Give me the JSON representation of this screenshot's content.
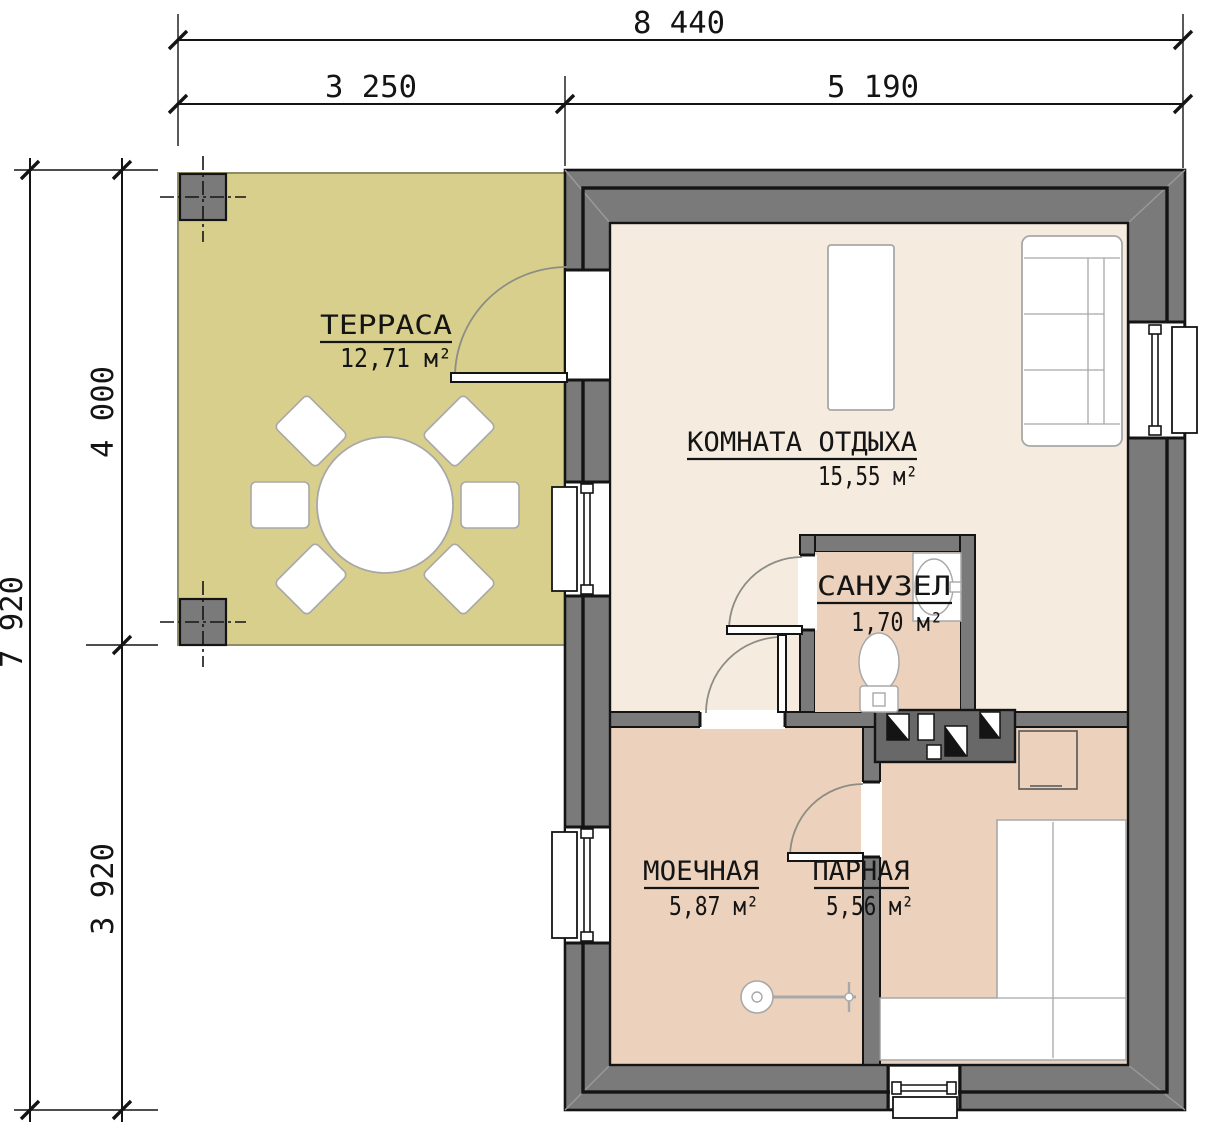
{
  "dimensions": {
    "top": {
      "total": "8 440",
      "seg1": "3 250",
      "seg2": "5 190"
    },
    "left": {
      "total": "7 920",
      "seg1": "4 000",
      "seg2": "3 920"
    }
  },
  "rooms": {
    "terrace": {
      "name": "ТЕРРАСА",
      "area": "12,71 м²"
    },
    "lounge": {
      "name": "КОМНАТА ОТДЫХА",
      "area": "15,55 м²"
    },
    "bathroom": {
      "name": "САНУЗЕЛ",
      "area": "1,70 м²"
    },
    "washroom": {
      "name": "МОЕЧНАЯ",
      "area": "5,87 м²"
    },
    "steamroom": {
      "name": "ПАРНАЯ",
      "area": "5,56 м²"
    }
  },
  "colors": {
    "wall": "#7a7a7a",
    "wall_dark": "#686868",
    "outline": "#141414",
    "terrace_floor": "#d8cf8d",
    "terrace_edge": "#8e8e66",
    "lounge_floor": "#f5ecdf",
    "wet_floor": "#ecd2bd",
    "furniture_stroke": "#a8a8a8",
    "door_arc": "#8d8d85",
    "miter": "#9a9a9a"
  }
}
